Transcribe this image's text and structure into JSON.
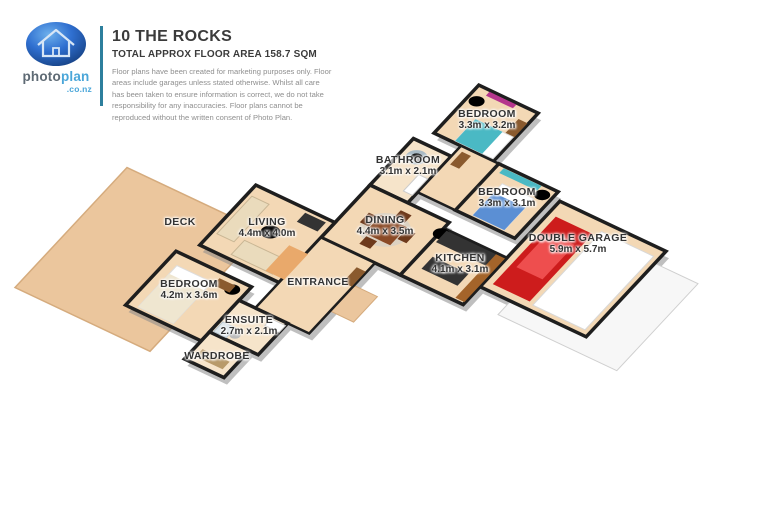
{
  "header": {
    "brand": {
      "part1": "photo",
      "part2": "plan",
      "tld": ".co.nz"
    },
    "title": "10 THE ROCKS",
    "subtitle": "TOTAL APPROX FLOOR AREA 158.7 SQM",
    "disclaimer": "Floor plans have been created for marketing purposes only. Floor areas include garages unless stated otherwise. Whilst all care has been taken to ensure information is correct, we do not take responsibility for any inaccuracies. Floor plans cannot be reproduced without the written consent of Photo Plan."
  },
  "floorplan": {
    "rooms": {
      "bedroom1": {
        "name": "BEDROOM",
        "dims": "3.3m x 3.2m"
      },
      "bathroom": {
        "name": "BATHROOM",
        "dims": "3.1m x 2.1m"
      },
      "bedroom2": {
        "name": "BEDROOM",
        "dims": "3.3m x 3.1m"
      },
      "garage": {
        "name": "DOUBLE GARAGE",
        "dims": "5.9m x 5.7m"
      },
      "dining": {
        "name": "DINING",
        "dims": "4.4m x 3.5m"
      },
      "kitchen": {
        "name": "KITCHEN",
        "dims": "4.1m x 3.1m"
      },
      "living": {
        "name": "LIVING",
        "dims": "4.4m x 4.0m"
      },
      "deck": {
        "name": "DECK",
        "dims": ""
      },
      "entrance": {
        "name": "ENTRANCE",
        "dims": ""
      },
      "bedroom3": {
        "name": "BEDROOM",
        "dims": "4.2m x 3.6m"
      },
      "ensuite": {
        "name": "ENSUITE",
        "dims": "2.7m x 2.1m"
      },
      "wardrobe": {
        "name": "WARDROBE",
        "dims": ""
      }
    },
    "colors": {
      "wall": "#1e1e1e",
      "floor": "#f3d8b5",
      "floorLight": "#f6e4ca",
      "deck": "#ebc69d",
      "deckEdge": "#d5ab7d",
      "driveway": "#f7f7f7",
      "shadow": "#8a8a8a",
      "sofa": "#eadbbc",
      "dark": "#333333",
      "lounger": "#e9a96b",
      "rugRed": "#cc4038",
      "white": "#ffffff",
      "rugCream": "#f6f2ea",
      "tableWood": "#8b4a26",
      "chairWood": "#6e3a1c",
      "plant": "#3f8f3a",
      "bench": "#a4642a",
      "car": "#cd1c1c",
      "carRoof": "#ee4e4e",
      "magenta": "#b5368d",
      "purple": "#8b3f9e",
      "wood": "#8a5a2e",
      "bedTeal": "#4ab9c4",
      "bedBlue": "#5b8fd4",
      "bedCream": "#efe6d0",
      "tub": "#e9eff3",
      "tubInner": "#c7d6de",
      "shower": "#dde7ec",
      "lightWood": "#b89a6a",
      "logoBlueLight": "#6db0ec",
      "logoBlueMid": "#2f6fd0",
      "logoBlueDark": "#123a78",
      "brandGray": "#5e6a74",
      "brandBlue": "#4aa6d9",
      "dividerTeal": "#2d7f9d"
    }
  }
}
